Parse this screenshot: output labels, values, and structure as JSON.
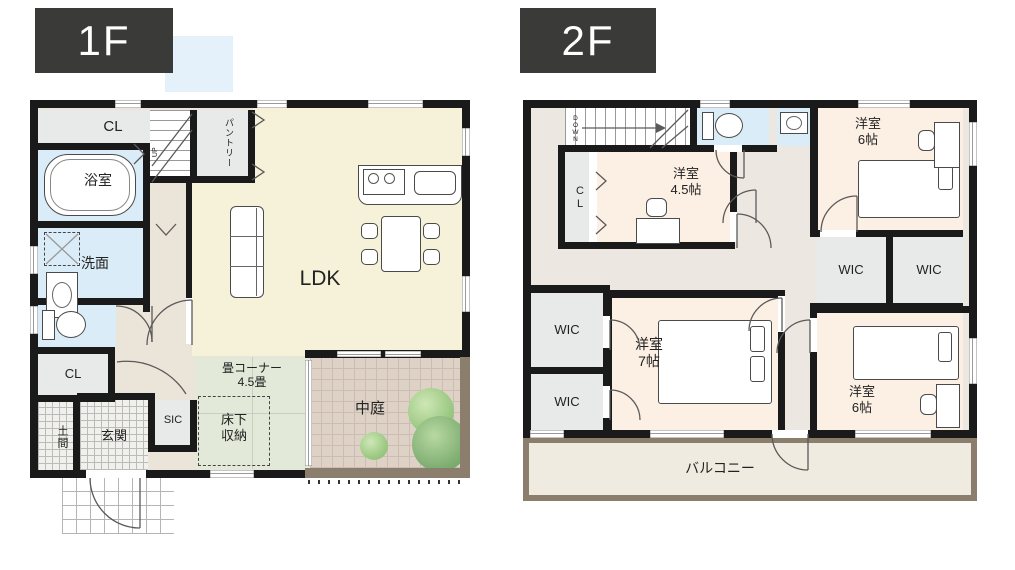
{
  "palette": {
    "wall": "#1a1a1a",
    "floor_label_box": "#3a3a38",
    "accent_blue_square": "#e4f1fb",
    "ldk_floor": "#f5f2d9",
    "hall_1f": "#ebe4d9",
    "wet_room": "#daecf7",
    "closet_gray": "#e8eaea",
    "tatami_green": "#e3e9d8",
    "courtyard_tile": "#ded2c7",
    "courtyard_border": "#8c7e6c",
    "bedroom_peach": "#fcefe3",
    "hall_2f": "#ece8e1",
    "balcony_floor": "#f0ebe0",
    "tree_green": "#9cc983"
  },
  "f1": {
    "label": "1F",
    "up": "UP",
    "rooms": {
      "cl_top": "CL",
      "pantry": "パントリー",
      "bath": "浴室",
      "wash": "洗面",
      "cl_small": "CL",
      "doma": "土間",
      "genkan": "玄関",
      "sic": "SIC",
      "underfloor": {
        "l1": "床下",
        "l2": "収納"
      },
      "tatami": {
        "l1": "畳コーナー",
        "l2": "4.5畳"
      },
      "ldk": "LDK",
      "courtyard": "中庭"
    }
  },
  "f2": {
    "label": "2F",
    "down": "DOWN",
    "rooms": {
      "cl": "CL",
      "room45": {
        "l1": "洋室",
        "l2": "4.5帖"
      },
      "room6_top": {
        "l1": "洋室",
        "l2": "6帖"
      },
      "wic_1": "WIC",
      "wic_2": "WIC",
      "room7": {
        "l1": "洋室",
        "l2": "7帖"
      },
      "wic_3": "WIC",
      "wic_4": "WIC",
      "room6_bottom": {
        "l1": "洋室",
        "l2": "6帖"
      },
      "balcony": "バルコニー"
    }
  }
}
